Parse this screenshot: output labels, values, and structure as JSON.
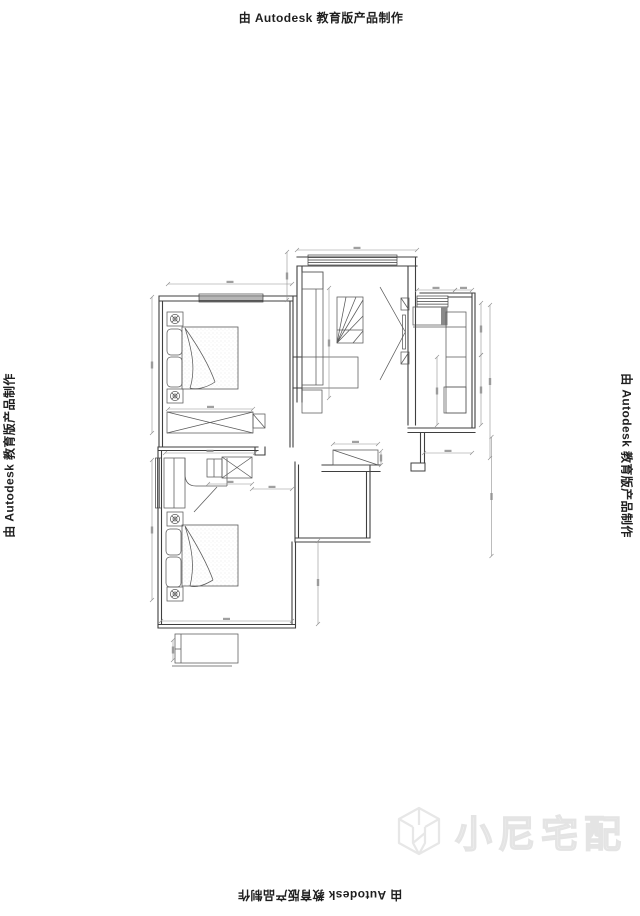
{
  "watermarks": {
    "top": "由 Autodesk 教育版产品制作",
    "bottom": "由 Autodesk 教育版产品制作",
    "left": "由 Autodesk 教育版产品制作",
    "right": "由 Autodesk 教育版产品制作"
  },
  "brand": {
    "name": "小尼宅配"
  },
  "colors": {
    "paper": "#ffffff",
    "ink": "#1f1f1f",
    "wall": "#3f3f3f",
    "line": "#5a5a5a",
    "dim": "#8f8f8f",
    "shade": "#8a8a8a",
    "brand": "#ececec"
  }
}
